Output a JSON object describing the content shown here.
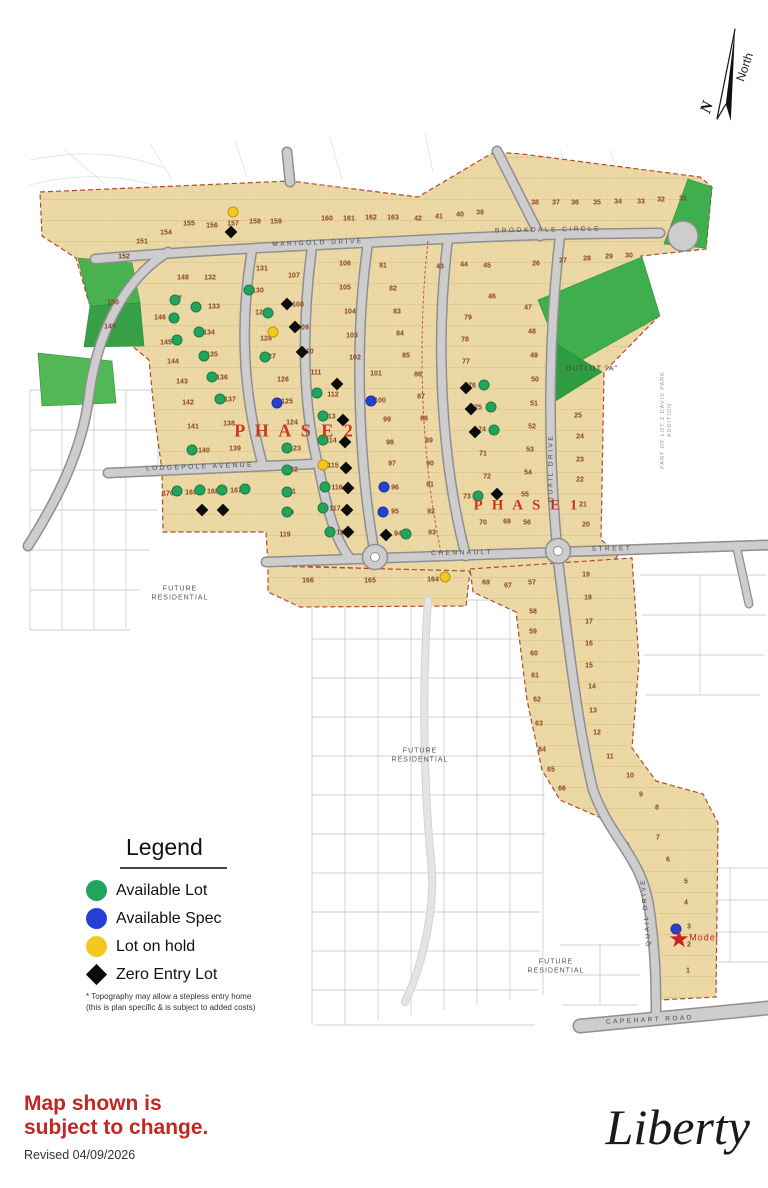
{
  "header": {
    "north_label": "North",
    "north_n": "N"
  },
  "legend": {
    "title": "Legend",
    "items": [
      {
        "key": "available-lot",
        "label": "Available Lot",
        "shape": "circle",
        "color": "#23a45c"
      },
      {
        "key": "available-spec",
        "label": "Available Spec",
        "shape": "circle",
        "color": "#2640d4"
      },
      {
        "key": "lot-on-hold",
        "label": "Lot on hold",
        "shape": "circle",
        "color": "#f4c81c"
      },
      {
        "key": "zero-entry-lot",
        "label": "Zero Entry Lot",
        "shape": "diamond",
        "color": "#0c0c0c"
      }
    ],
    "footnote": "* Topography may allow a stepless entry home (this is plan specific & is subject to added costs)"
  },
  "footer": {
    "notice_line1": "Map shown is",
    "notice_line2": "subject to change.",
    "revised": "Revised 04/09/2026",
    "brand": "Liberty"
  },
  "map": {
    "phase_labels": [
      {
        "text": "P H A S E  2",
        "x": 295,
        "y": 431,
        "size": 18
      },
      {
        "text": "P H A S E  1",
        "x": 527,
        "y": 506,
        "size": 15
      }
    ],
    "street_labels": [
      {
        "text": "MARIGOLD  DRIVE",
        "x": 318,
        "y": 243,
        "rot": -2
      },
      {
        "text": "BROOKDALE  CIRCLE",
        "x": 548,
        "y": 230,
        "rot": -1
      },
      {
        "text": "LODGEPOLE  AVENUE",
        "x": 200,
        "y": 467,
        "rot": -2
      },
      {
        "text": "CHENNAULT",
        "x": 462,
        "y": 553,
        "rot": -1
      },
      {
        "text": "STREET",
        "x": 612,
        "y": 549,
        "rot": -1
      },
      {
        "text": "QUAIL  DRIVE",
        "x": 551,
        "y": 468,
        "rot": -90
      },
      {
        "text": "QUAIL  DRIVE",
        "x": 646,
        "y": 912,
        "rot": -95
      },
      {
        "text": "CAPEHART   ROAD",
        "x": 650,
        "y": 1020,
        "rot": -3
      }
    ],
    "area_labels": [
      {
        "text": "FUTURE\nRESIDENTIAL",
        "x": 180,
        "y": 594
      },
      {
        "text": "FUTURE\nRESIDENTIAL",
        "x": 420,
        "y": 756
      },
      {
        "text": "FUTURE\nRESIDENTIAL",
        "x": 556,
        "y": 967
      },
      {
        "text": "OUTLOT  \"A\"",
        "x": 592,
        "y": 368,
        "size": 7.5,
        "color": "#444"
      },
      {
        "text": "PART OF LOT 2 DAVIS PARK ADDITION",
        "x": 667,
        "y": 420,
        "rot": -90,
        "size": 5.5,
        "color": "#999"
      },
      {
        "text": "Model",
        "x": 704,
        "y": 938,
        "size": 9,
        "color": "#cc2222"
      }
    ],
    "lots": [
      [
        152,
        124,
        257
      ],
      [
        151,
        142,
        242
      ],
      [
        154,
        166,
        233
      ],
      [
        155,
        189,
        224
      ],
      [
        156,
        212,
        226
      ],
      [
        157,
        233,
        224
      ],
      [
        158,
        255,
        222
      ],
      [
        159,
        276,
        222
      ],
      [
        160,
        327,
        219
      ],
      [
        161,
        349,
        219
      ],
      [
        162,
        371,
        218
      ],
      [
        163,
        393,
        218
      ],
      [
        150,
        113,
        303
      ],
      [
        149,
        110,
        327
      ],
      [
        42,
        418,
        219
      ],
      [
        41,
        439,
        217
      ],
      [
        40,
        460,
        215
      ],
      [
        39,
        480,
        213
      ],
      [
        38,
        535,
        203
      ],
      [
        37,
        556,
        203
      ],
      [
        36,
        575,
        203
      ],
      [
        35,
        597,
        203
      ],
      [
        34,
        618,
        202
      ],
      [
        33,
        641,
        202
      ],
      [
        32,
        661,
        200
      ],
      [
        31,
        683,
        199
      ],
      [
        26,
        536,
        264
      ],
      [
        27,
        563,
        261
      ],
      [
        28,
        587,
        259
      ],
      [
        29,
        609,
        257
      ],
      [
        30,
        629,
        256
      ],
      [
        43,
        440,
        267
      ],
      [
        44,
        464,
        265
      ],
      [
        45,
        487,
        266
      ],
      [
        46,
        492,
        297
      ],
      [
        148,
        183,
        278
      ],
      [
        147,
        176,
        299
      ],
      [
        146,
        160,
        318
      ],
      [
        145,
        166,
        343
      ],
      [
        144,
        173,
        362
      ],
      [
        143,
        182,
        382
      ],
      [
        142,
        188,
        403
      ],
      [
        141,
        193,
        427
      ],
      [
        140,
        204,
        451
      ],
      [
        139,
        235,
        449
      ],
      [
        138,
        229,
        424
      ],
      [
        132,
        210,
        278
      ],
      [
        133,
        214,
        307
      ],
      [
        134,
        209,
        333
      ],
      [
        135,
        212,
        355
      ],
      [
        136,
        222,
        378
      ],
      [
        137,
        230,
        400
      ],
      [
        131,
        262,
        269
      ],
      [
        130,
        258,
        291
      ],
      [
        129,
        261,
        313
      ],
      [
        128,
        266,
        339
      ],
      [
        127,
        270,
        357
      ],
      [
        126,
        283,
        380
      ],
      [
        125,
        287,
        402
      ],
      [
        124,
        292,
        423
      ],
      [
        123,
        295,
        449
      ],
      [
        122,
        292,
        470
      ],
      [
        121,
        290,
        492
      ],
      [
        120,
        288,
        513
      ],
      [
        119,
        285,
        535
      ],
      [
        107,
        294,
        276
      ],
      [
        108,
        298,
        305
      ],
      [
        109,
        303,
        328
      ],
      [
        110,
        308,
        352
      ],
      [
        111,
        316,
        373
      ],
      [
        112,
        333,
        395
      ],
      [
        113,
        330,
        417
      ],
      [
        114,
        331,
        441
      ],
      [
        115,
        333,
        466
      ],
      [
        116,
        337,
        488
      ],
      [
        117,
        335,
        509
      ],
      [
        118,
        342,
        533
      ],
      [
        106,
        345,
        264
      ],
      [
        105,
        345,
        288
      ],
      [
        104,
        350,
        312
      ],
      [
        103,
        352,
        336
      ],
      [
        102,
        355,
        358
      ],
      [
        101,
        376,
        374
      ],
      [
        81,
        383,
        266
      ],
      [
        82,
        393,
        289
      ],
      [
        83,
        397,
        312
      ],
      [
        84,
        400,
        334
      ],
      [
        85,
        406,
        356
      ],
      [
        100,
        380,
        401
      ],
      [
        99,
        387,
        420
      ],
      [
        98,
        390,
        443
      ],
      [
        97,
        392,
        464
      ],
      [
        96,
        395,
        488
      ],
      [
        95,
        395,
        512
      ],
      [
        94,
        398,
        534
      ],
      [
        86,
        418,
        375
      ],
      [
        87,
        421,
        397
      ],
      [
        88,
        424,
        419
      ],
      [
        89,
        429,
        441
      ],
      [
        90,
        430,
        464
      ],
      [
        91,
        430,
        485
      ],
      [
        92,
        431,
        512
      ],
      [
        93,
        432,
        533
      ],
      [
        79,
        468,
        318
      ],
      [
        78,
        465,
        340
      ],
      [
        77,
        466,
        362
      ],
      [
        76,
        472,
        386
      ],
      [
        75,
        478,
        408
      ],
      [
        74,
        482,
        430
      ],
      [
        73,
        467,
        497
      ],
      [
        72,
        487,
        477
      ],
      [
        71,
        483,
        454
      ],
      [
        70,
        483,
        523
      ],
      [
        68,
        507,
        522
      ],
      [
        56,
        527,
        523
      ],
      [
        55,
        525,
        495
      ],
      [
        47,
        528,
        308
      ],
      [
        48,
        532,
        332
      ],
      [
        49,
        534,
        356
      ],
      [
        50,
        535,
        380
      ],
      [
        51,
        534,
        404
      ],
      [
        52,
        532,
        427
      ],
      [
        53,
        530,
        450
      ],
      [
        54,
        528,
        473
      ],
      [
        25,
        578,
        416
      ],
      [
        24,
        580,
        437
      ],
      [
        23,
        580,
        460
      ],
      [
        22,
        580,
        480
      ],
      [
        21,
        583,
        505
      ],
      [
        20,
        586,
        525
      ],
      [
        19,
        586,
        575
      ],
      [
        18,
        588,
        598
      ],
      [
        17,
        589,
        622
      ],
      [
        16,
        589,
        644
      ],
      [
        15,
        589,
        666
      ],
      [
        14,
        592,
        687
      ],
      [
        13,
        593,
        711
      ],
      [
        12,
        597,
        733
      ],
      [
        11,
        610,
        757
      ],
      [
        10,
        630,
        776
      ],
      [
        9,
        641,
        795
      ],
      [
        8,
        657,
        808
      ],
      [
        69,
        486,
        583
      ],
      [
        67,
        508,
        586
      ],
      [
        57,
        532,
        583
      ],
      [
        58,
        533,
        612
      ],
      [
        59,
        533,
        632
      ],
      [
        60,
        534,
        654
      ],
      [
        61,
        535,
        676
      ],
      [
        62,
        537,
        700
      ],
      [
        63,
        539,
        724
      ],
      [
        64,
        542,
        750
      ],
      [
        65,
        551,
        770
      ],
      [
        66,
        562,
        789
      ],
      [
        166,
        308,
        581
      ],
      [
        165,
        370,
        581
      ],
      [
        164,
        433,
        580
      ],
      [
        170,
        168,
        494
      ],
      [
        169,
        191,
        493
      ],
      [
        168,
        213,
        492
      ],
      [
        167,
        236,
        491
      ],
      [
        7,
        658,
        838
      ],
      [
        6,
        668,
        860
      ],
      [
        5,
        686,
        882
      ],
      [
        4,
        686,
        903
      ],
      [
        3,
        689,
        927
      ],
      [
        2,
        689,
        945
      ],
      [
        1,
        688,
        971
      ]
    ],
    "dots": {
      "green": [
        [
          175,
          300
        ],
        [
          196,
          307
        ],
        [
          174,
          318
        ],
        [
          199,
          332
        ],
        [
          177,
          340
        ],
        [
          204,
          356
        ],
        [
          212,
          377
        ],
        [
          220,
          399
        ],
        [
          192,
          450
        ],
        [
          177,
          491
        ],
        [
          200,
          490
        ],
        [
          222,
          490
        ],
        [
          245,
          489
        ],
        [
          249,
          290
        ],
        [
          268,
          313
        ],
        [
          265,
          357
        ],
        [
          287,
          448
        ],
        [
          287,
          470
        ],
        [
          287,
          492
        ],
        [
          287,
          512
        ],
        [
          317,
          393
        ],
        [
          323,
          416
        ],
        [
          323,
          440
        ],
        [
          325,
          487
        ],
        [
          323,
          508
        ],
        [
          330,
          532
        ],
        [
          406,
          534
        ],
        [
          484,
          385
        ],
        [
          491,
          407
        ],
        [
          494,
          430
        ],
        [
          478,
          496
        ]
      ],
      "blue": [
        [
          277,
          403
        ],
        [
          371,
          401
        ],
        [
          384,
          487
        ],
        [
          383,
          512
        ],
        [
          676,
          929
        ]
      ],
      "yellow": [
        [
          233,
          212
        ],
        [
          273,
          332
        ],
        [
          323,
          465
        ],
        [
          445,
          577
        ]
      ],
      "diamond": [
        [
          231,
          232
        ],
        [
          202,
          510
        ],
        [
          223,
          510
        ],
        [
          287,
          304
        ],
        [
          295,
          327
        ],
        [
          302,
          352
        ],
        [
          337,
          384
        ],
        [
          343,
          420
        ],
        [
          345,
          442
        ],
        [
          346,
          468
        ],
        [
          348,
          488
        ],
        [
          347,
          510
        ],
        [
          348,
          532
        ],
        [
          386,
          535
        ],
        [
          466,
          388
        ],
        [
          471,
          409
        ],
        [
          475,
          432
        ],
        [
          497,
          494
        ]
      ],
      "star": [
        [
          679,
          941
        ]
      ]
    },
    "colors": {
      "available": "#23a45c",
      "spec": "#2640d4",
      "hold": "#f4c81c",
      "zero_entry": "#0c0c0c",
      "parcel": "#ecd8a4",
      "street": "#cdcdcd",
      "boundary": "#b5472b",
      "green_space": "#3fae4c",
      "phase_text": "#c8391e",
      "lot_number": "#8a4520",
      "model": "#cc2222"
    }
  }
}
